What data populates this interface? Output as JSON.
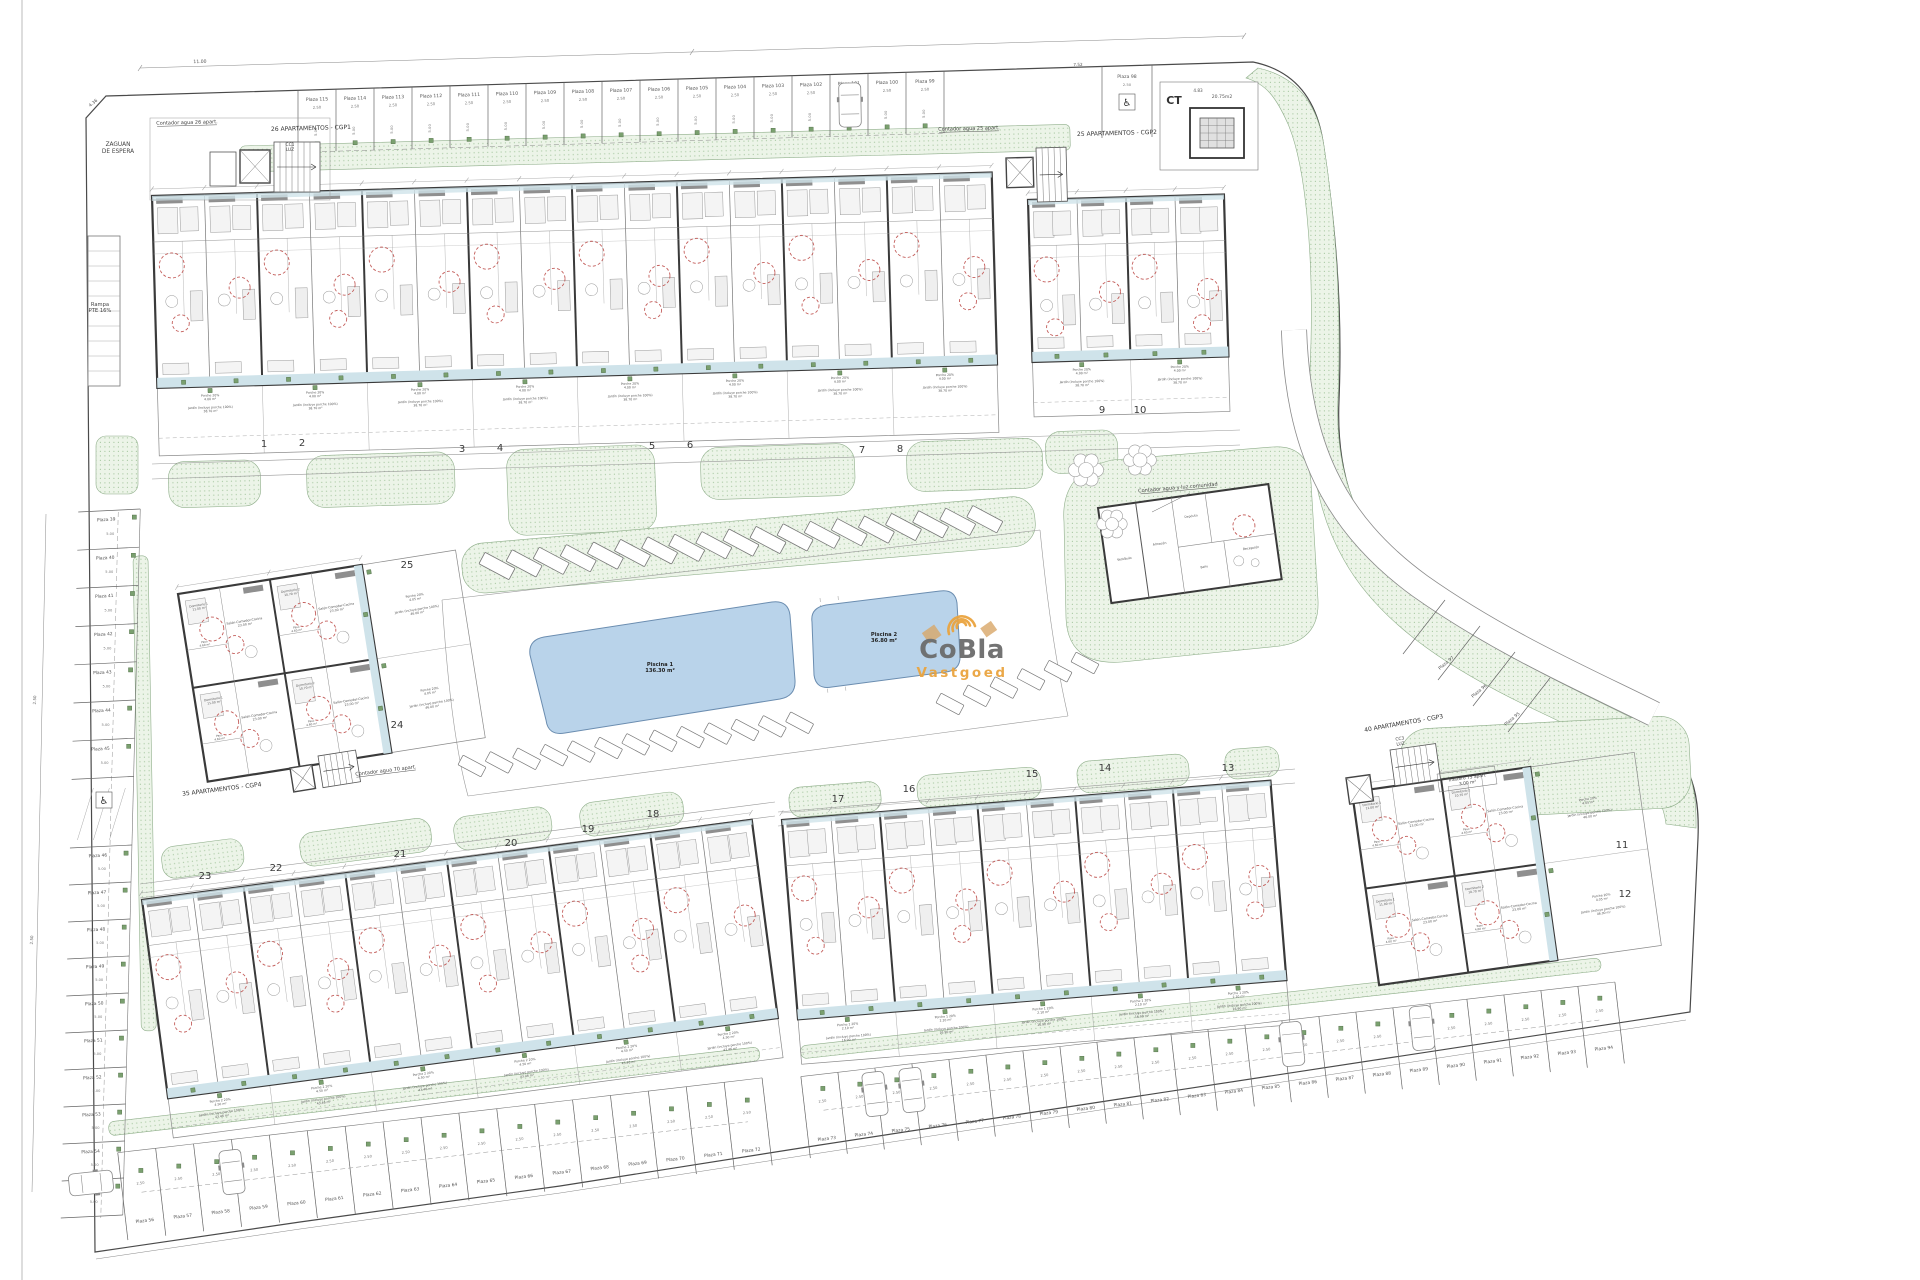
{
  "canvas": {
    "width": 1920,
    "height": 1280,
    "background": "#ffffff"
  },
  "palette": {
    "line": "#4a4a4a",
    "green_fill": "#ecf4e8",
    "green_dot": "#a9c9a3",
    "green_edge": "#8fae8a",
    "pool_fill": "#b9d3ea",
    "pool_edge": "#6b8db0",
    "wall": "#3a3a3a",
    "red_circle": "#b8413d",
    "terrace": "#cfe3ea",
    "meter_green": "#7aa06f",
    "logo_gray": "#6c6c6c",
    "logo_orange": "#eaa43f",
    "logo_tan": "#d8a768"
  },
  "logo": {
    "name": "CoBla",
    "sub": "Vastgoed"
  },
  "pools": [
    {
      "name": "Piscina 1",
      "area": "136.30 m²"
    },
    {
      "name": "Piscina 2",
      "area": "36.80 m²"
    }
  ],
  "transformer": {
    "label": "CT",
    "area": "20.75m2"
  },
  "annotations": {
    "zaguan": [
      "ZAGUAN",
      "DE ESPERA"
    ],
    "rampa": [
      "Rampa",
      "PTE 16%"
    ],
    "contador26": "Contador agua 26 apart.",
    "cgp1": "26 APARTAMENTOS - CGP1",
    "contador25": "Contador agua 25 apart.",
    "cgp2": "25 APARTAMENTOS - CGP2",
    "contador_com": "Contador agua y luz comunidad",
    "cgp3": "40 APARTAMENTOS - CGP3",
    "cgp4": "35 APARTAMENTOS - CGP4",
    "contador70": "Contador agua 70 apart.",
    "trastero": [
      "Trastero 75 apart",
      "3.00 m²"
    ],
    "cc1": [
      "CC1",
      "LUZ"
    ],
    "cc3": [
      "CC3",
      "LUZ"
    ]
  },
  "dimensions": {
    "stall_width": "2.50",
    "stall_depth": "5.00",
    "top_span": "11.00",
    "corner": "4.36",
    "d1": "7.52",
    "d2": "4.83"
  },
  "building_numbers": [
    "1",
    "2",
    "3",
    "4",
    "5",
    "6",
    "7",
    "8",
    "9",
    "10",
    "11",
    "12",
    "13",
    "14",
    "15",
    "16",
    "17",
    "18",
    "19",
    "20",
    "21",
    "22",
    "23",
    "24",
    "25"
  ],
  "parking": {
    "top_row": [
      "Plaza 115",
      "Plaza 114",
      "Plaza 113",
      "Plaza 112",
      "Plaza 111",
      "Plaza 110",
      "Plaza 109",
      "Plaza 108",
      "Plaza 107",
      "Plaza 106",
      "Plaza 105",
      "Plaza 104",
      "Plaza 103",
      "Plaza 102",
      "Plaza 101",
      "Plaza 100",
      "Plaza 99"
    ],
    "accessible_top": "Plaza 98",
    "left_row_a": [
      "Plaza 39",
      "Plaza 40",
      "Plaza 41",
      "Plaza 42",
      "Plaza 43",
      "Plaza 44",
      "Plaza 45"
    ],
    "left_row_b": [
      "Plaza 46",
      "Plaza 47",
      "Plaza 48",
      "Plaza 49",
      "Plaza 50",
      "Plaza 51",
      "Plaza 52",
      "Plaza 53",
      "Plaza 54",
      "Plaza 55"
    ],
    "bottom_row_a": [
      "Plaza 56",
      "Plaza 57",
      "Plaza 58",
      "Plaza 59",
      "Plaza 60",
      "Plaza 61",
      "Plaza 62",
      "Plaza 63",
      "Plaza 64",
      "Plaza 65",
      "Plaza 66",
      "Plaza 67",
      "Plaza 68",
      "Plaza 69",
      "Plaza 70",
      "Plaza 71",
      "Plaza 72"
    ],
    "bottom_row_b": [
      "Plaza 73",
      "Plaza 74",
      "Plaza 75",
      "Plaza 76",
      "Plaza 77",
      "Plaza 78",
      "Plaza 79",
      "Plaza 80",
      "Plaza 81",
      "Plaza 82",
      "Plaza 83",
      "Plaza 84",
      "Plaza 85",
      "Plaza 86",
      "Plaza 87",
      "Plaza 88",
      "Plaza 89",
      "Plaza 90",
      "Plaza 91",
      "Plaza 92",
      "Plaza 93",
      "Plaza 94"
    ],
    "right_diag": [
      "Plaza 97",
      "Plaza 96",
      "Plaza 95"
    ]
  },
  "unit_labels": {
    "salon": [
      "Salón-Comedor-Cocina",
      "23.00 m²"
    ],
    "dorm1": [
      "Dormitorio 1",
      "11.00 m²"
    ],
    "dorm2": [
      "Dormitorio 2",
      "10.70 m²"
    ],
    "dorm3": [
      "Dormitorio 3",
      "8.00 m²"
    ],
    "bano1": [
      "Baño 1",
      "3.50 m²"
    ],
    "bano2": [
      "Baño 2",
      "2.40 m²"
    ],
    "paso": [
      "Paso",
      "4.60 m²"
    ],
    "porche_a": [
      "Porche 20%",
      "4.00 m²"
    ],
    "jardin_a": [
      "Jardín (incluye porche 100%)",
      "38.70 m²"
    ],
    "porche_b": [
      "Porche 1 20%",
      "2.10 m²"
    ],
    "jardin_b": [
      "Jardín (incluye porche 100%)",
      "16.90 m²"
    ],
    "porche_c": [
      "Porche 2 20%",
      "4.50 m²"
    ],
    "jardin_c": [
      "Jardín (incluye porche 100%)",
      "43.46 m²"
    ],
    "porche_d": [
      "Porche 20%",
      "4.05 m²"
    ],
    "jardin_d": [
      "Jardín (incluye porche 100%)",
      "46.00 m²"
    ]
  },
  "communal_rooms": [
    "Vestíbulo",
    "Almacén",
    "Recepción",
    "Baño",
    "Depósito"
  ]
}
